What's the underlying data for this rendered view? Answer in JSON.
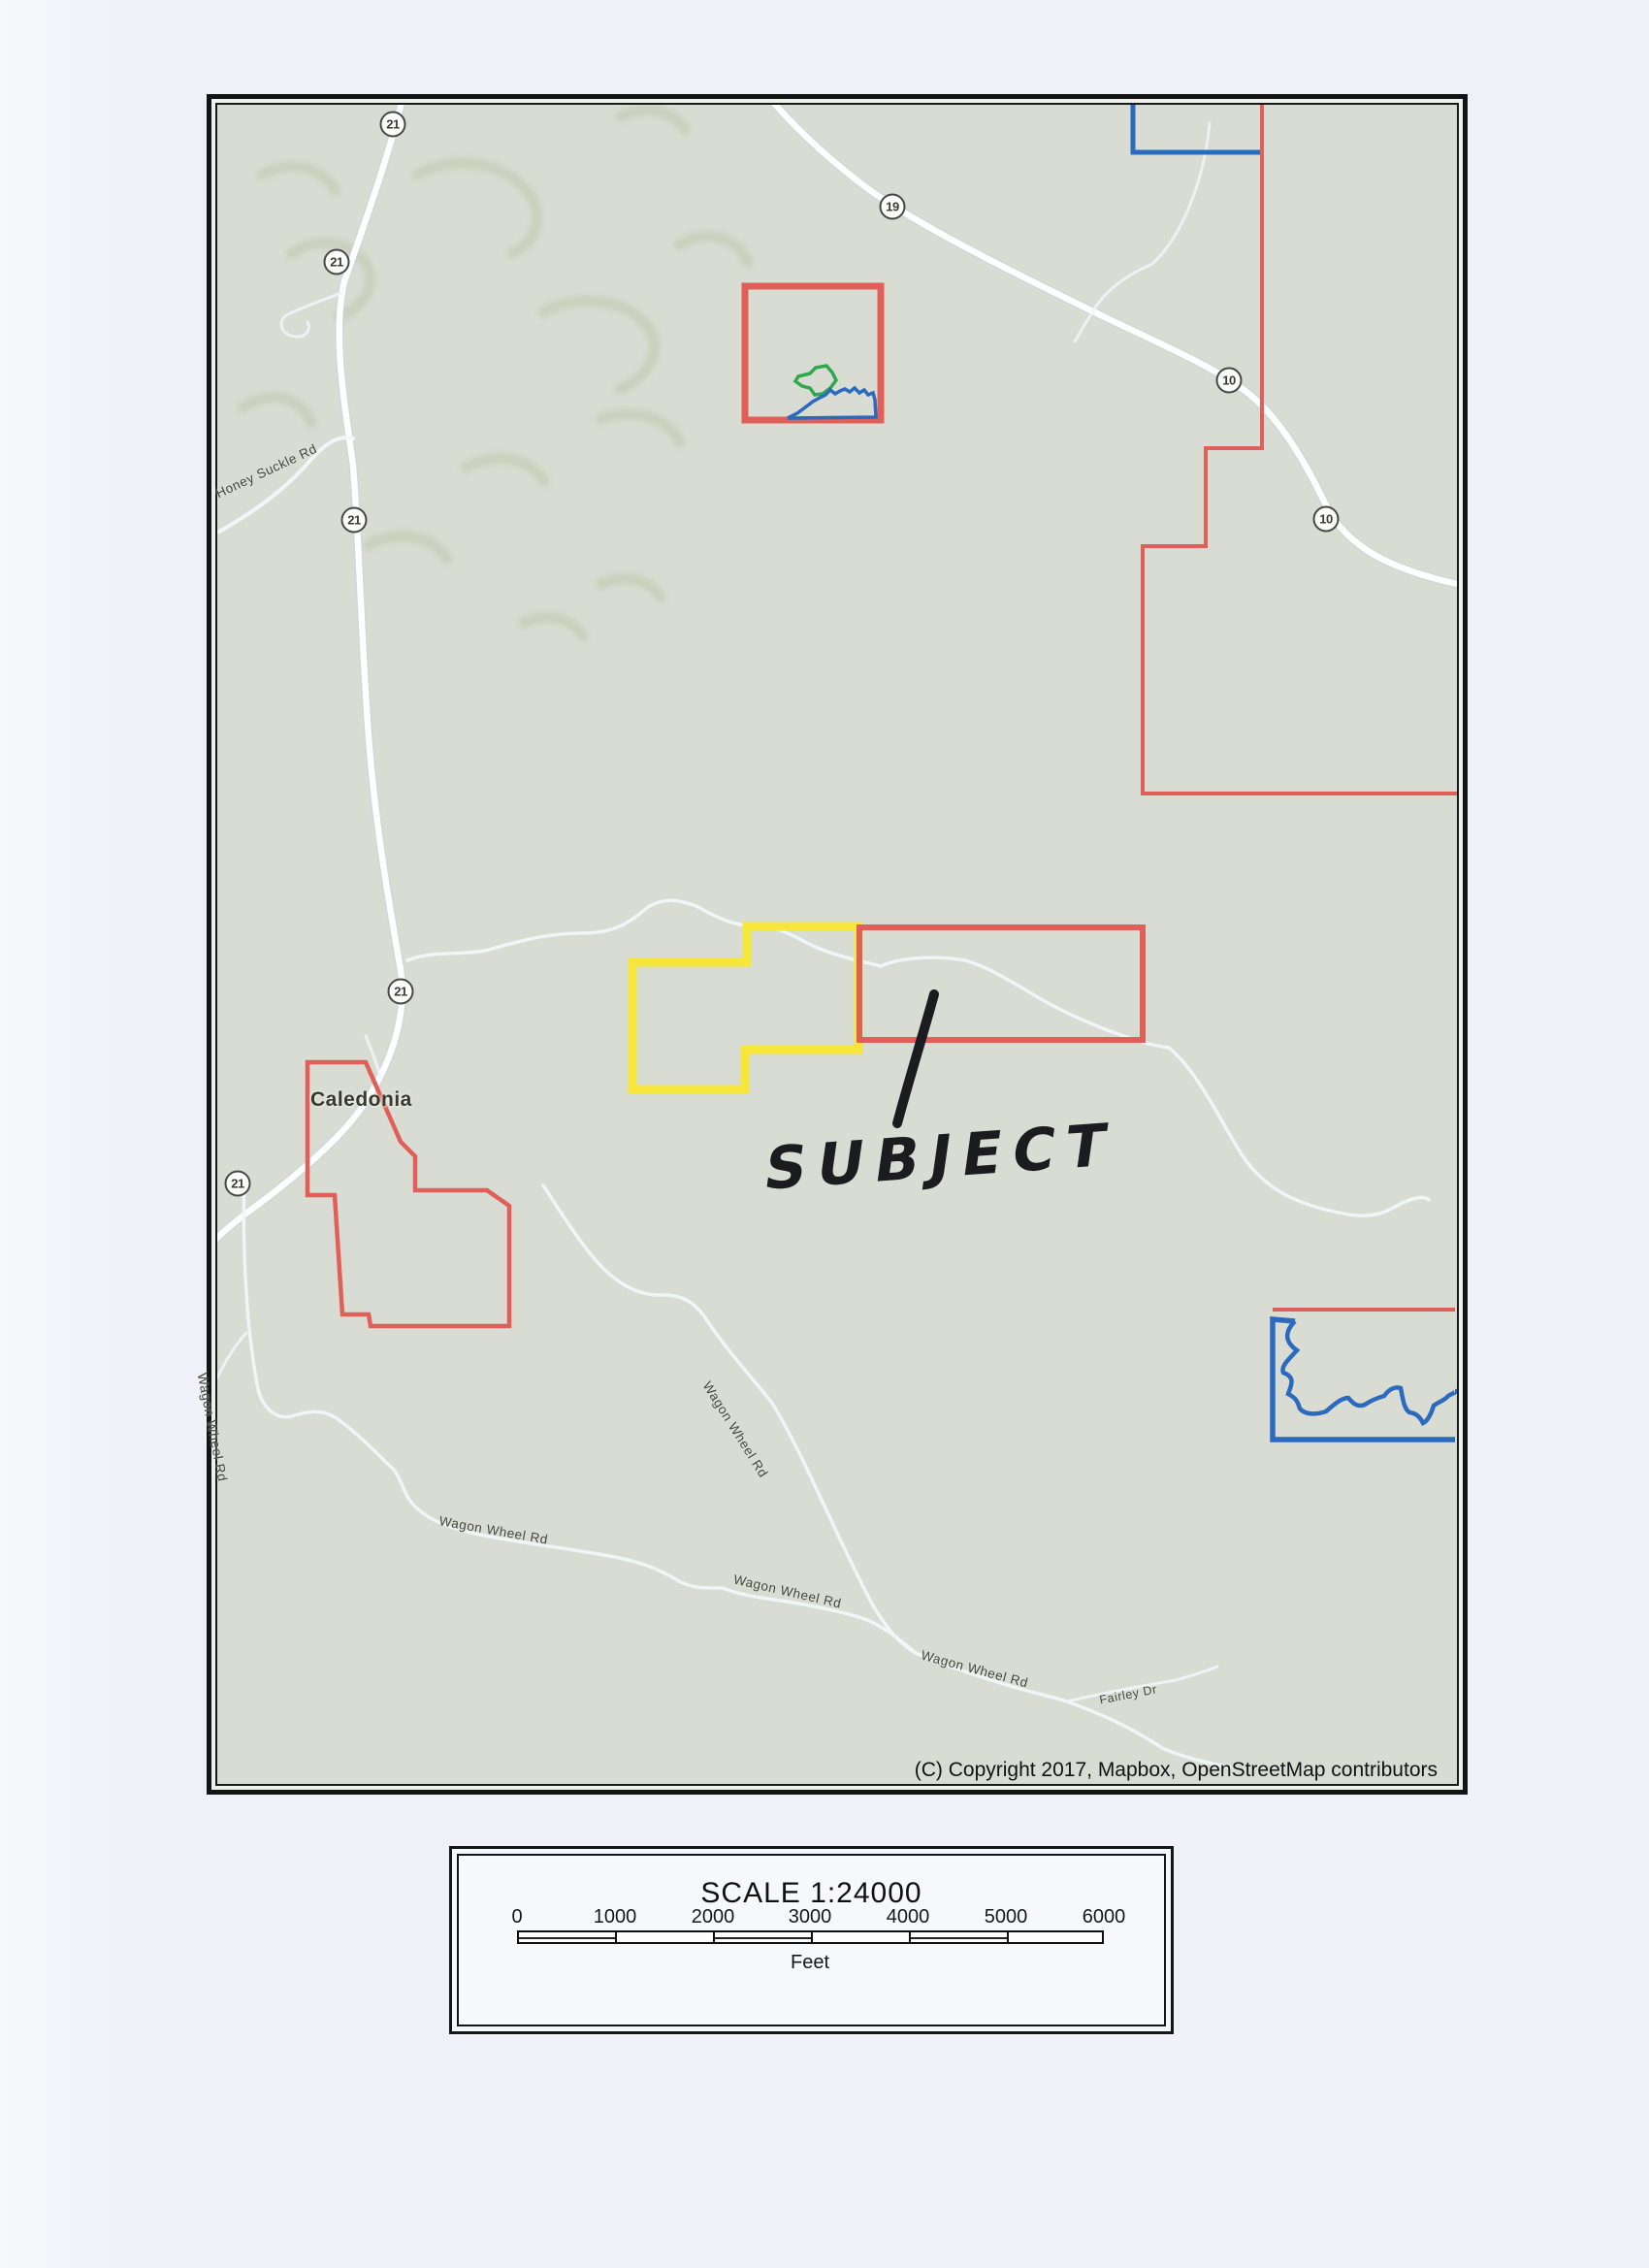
{
  "map": {
    "town_label": "Caledonia",
    "subject_label": "SUBJECT",
    "copyright": "(C) Copyright 2017, Mapbox, OpenStreetMap contributors",
    "route_markers": [
      {
        "num": "21"
      },
      {
        "num": "21"
      },
      {
        "num": "21"
      },
      {
        "num": "21"
      },
      {
        "num": "21"
      },
      {
        "num": "19"
      },
      {
        "num": "10"
      },
      {
        "num": "10"
      }
    ],
    "road_labels": [
      {
        "text": "Honey Suckle Rd"
      },
      {
        "text": "Wagon Wheel Rd"
      },
      {
        "text": "Wagon Wheel Rd"
      },
      {
        "text": "Wagon Wheel Rd"
      },
      {
        "text": "Wagon Wheel Rd"
      },
      {
        "text": "Wagon Wheel Rd"
      },
      {
        "text": "Fairley Dr"
      }
    ],
    "colors": {
      "parcel_red": "#e05f58",
      "parcel_yellow": "#f6e73a",
      "parcel_blue": "#2a6abf",
      "parcel_green": "#2fa84f",
      "marker_ink": "#1b1b20",
      "map_background": "#d9dcd2",
      "road_white": "#ffffff"
    }
  },
  "scale_panel": {
    "title": "SCALE 1:24000",
    "unit_label": "Feet",
    "tick_labels": [
      "0",
      "1000",
      "2000",
      "3000",
      "4000",
      "5000",
      "6000"
    ]
  }
}
